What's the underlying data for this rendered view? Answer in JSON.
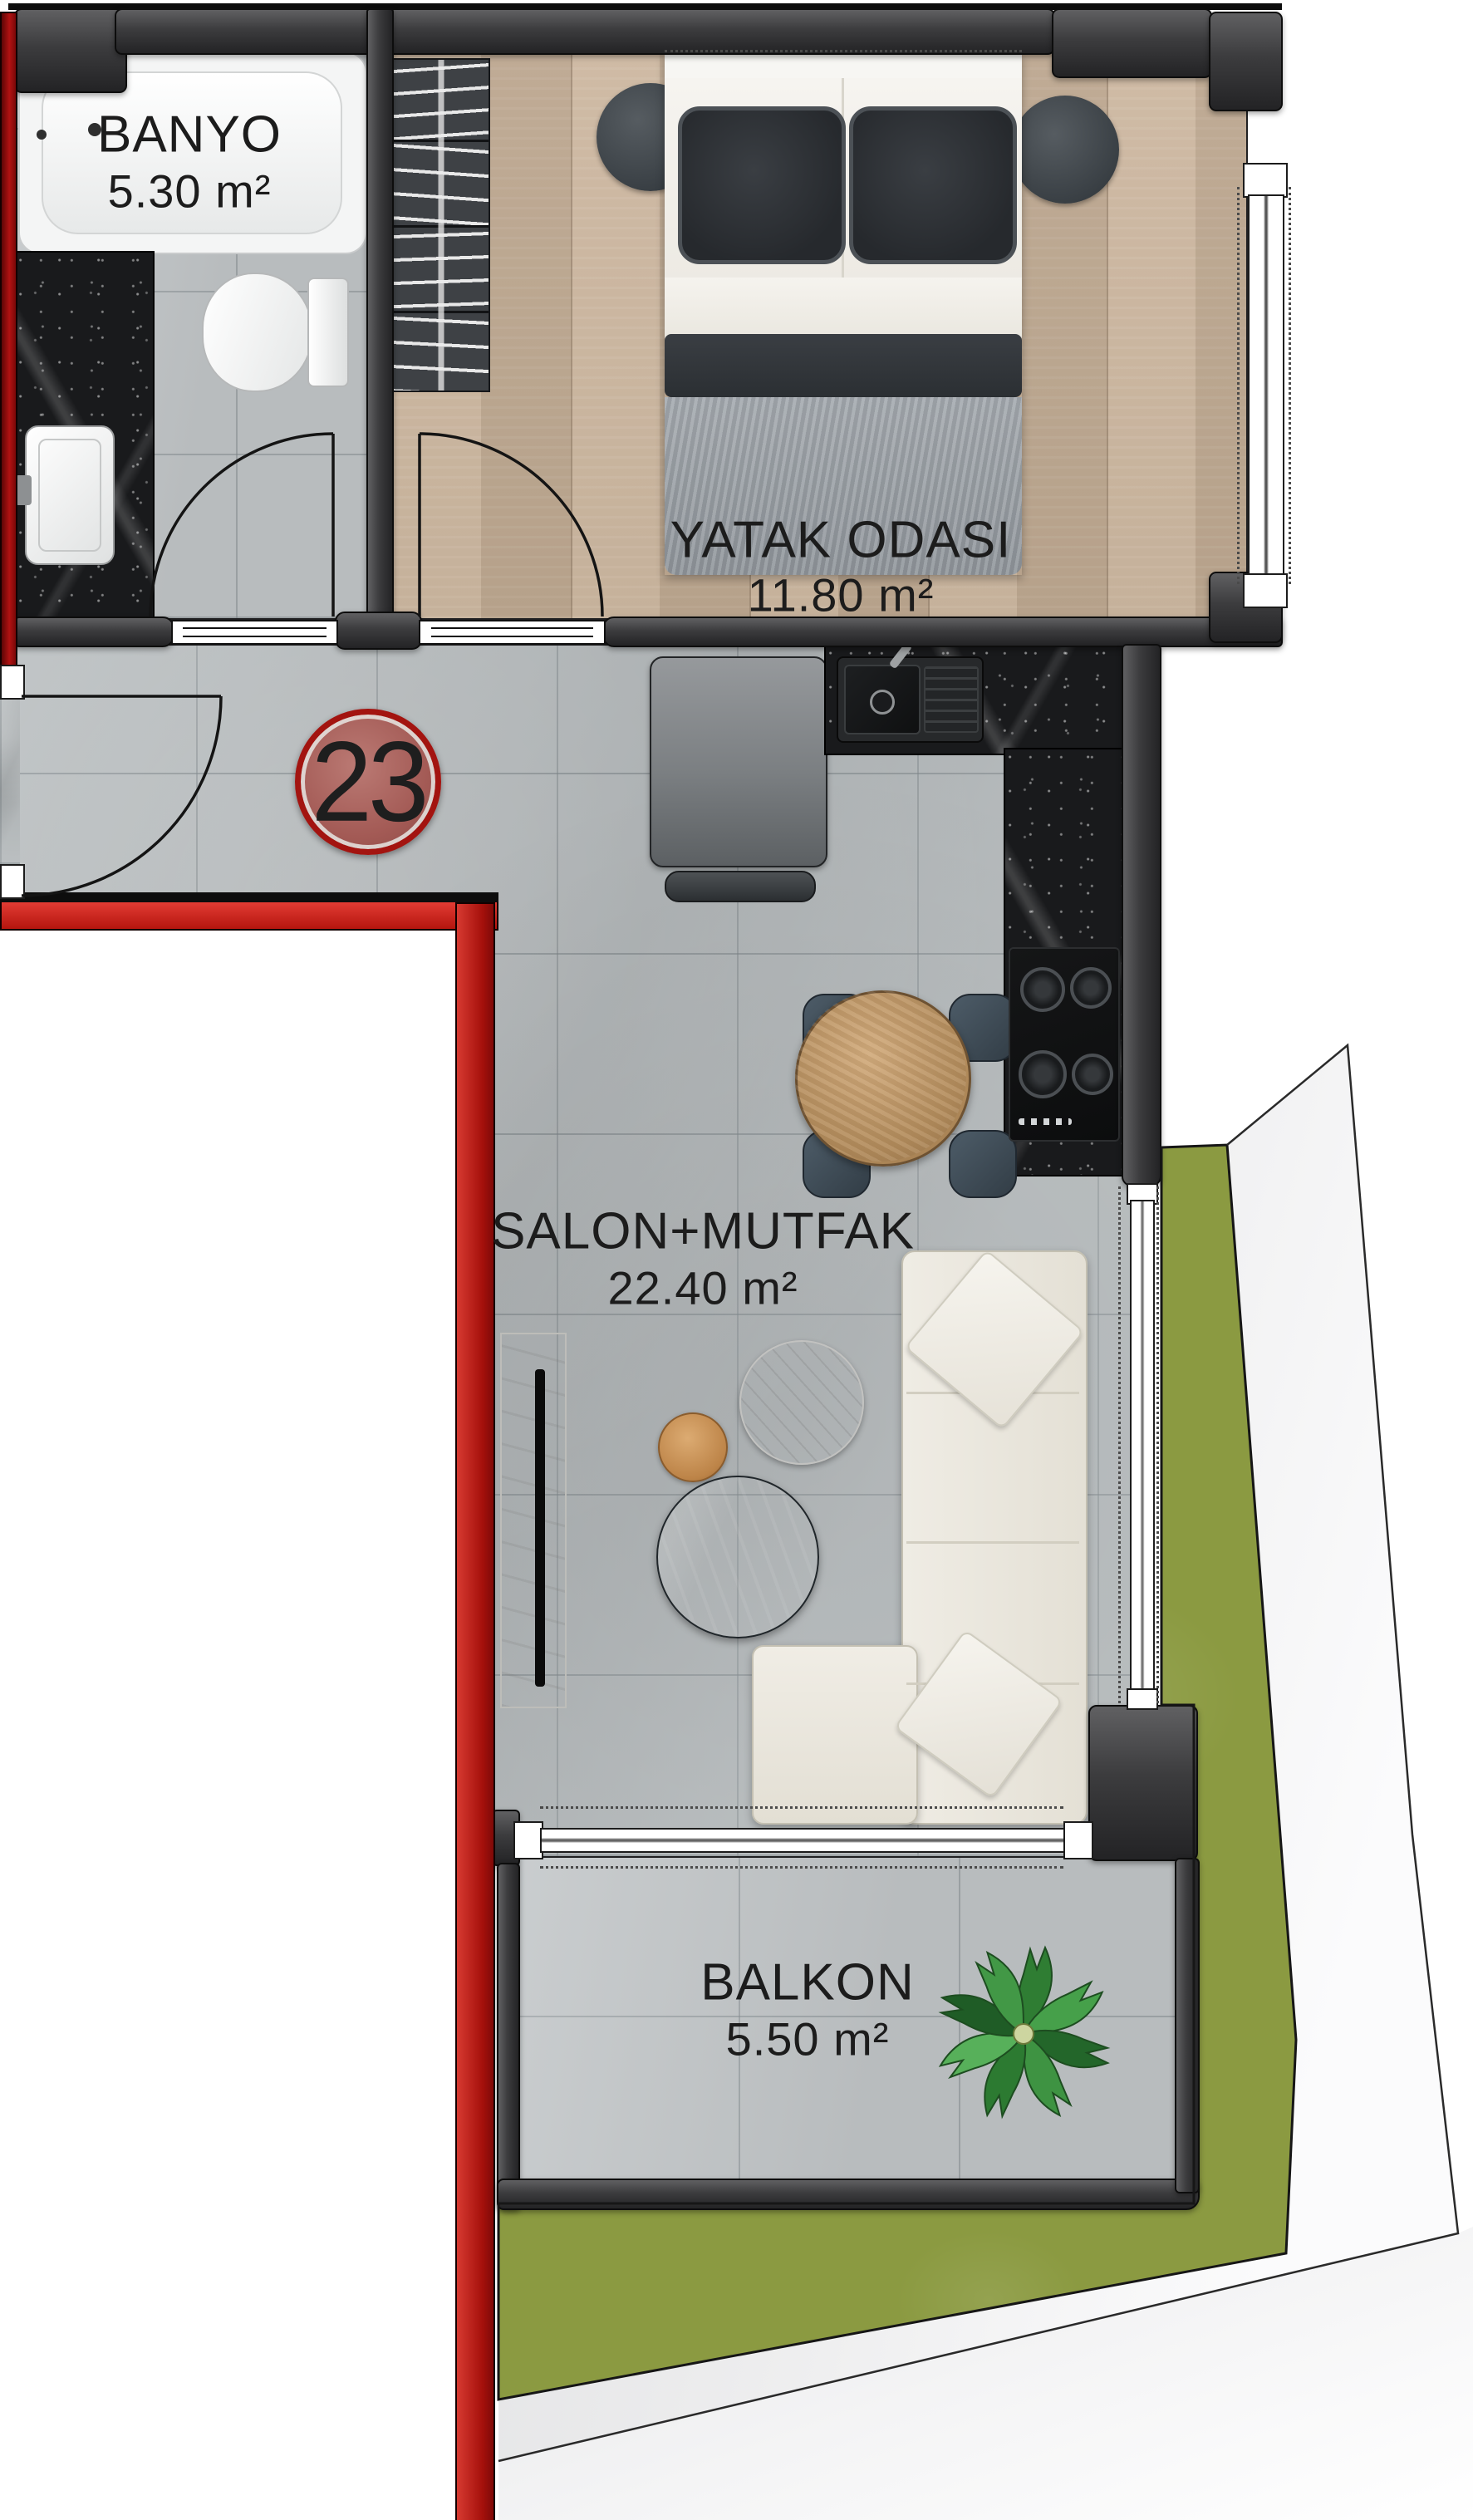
{
  "title": "Apartment unit 23 floor plan",
  "unit": {
    "number": "23"
  },
  "rooms": [
    {
      "id": "banyo",
      "label": "BANYO",
      "area": "5.30 m²"
    },
    {
      "id": "yatak-odasi",
      "label": "YATAK ODASI",
      "area": "11.80 m²"
    },
    {
      "id": "salon-mutfak",
      "label": "SALON+MUTFAK",
      "area": "22.40 m²"
    },
    {
      "id": "balkon",
      "label": "BALKON",
      "area": "5.50 m²"
    }
  ],
  "colors": {
    "unit_wall_red": "#c2221a",
    "badge_fill": "#a85d57",
    "badge_ring": "#a31410",
    "wall_dark": "#3a3a3c",
    "bedroom_wood": "#c9b299",
    "tile_gray": "#b5babc",
    "counter_marble": "#1a1b1d",
    "grass_green": "#8b9a41",
    "label_text": "#1c1c1c"
  },
  "furniture": {
    "bathroom": [
      "bathtub",
      "vanity-sink",
      "toilet"
    ],
    "bedroom": [
      "wardrobe",
      "double-bed",
      "bedside-rug-left",
      "bedside-rug-right"
    ],
    "kitchen": [
      "refrigerator",
      "kitchen-sink",
      "cooktop",
      "counter-column"
    ],
    "living": [
      "l-shaped-sofa",
      "tv-unit",
      "round-coffee-tables",
      "dining-table",
      "dining-chairs"
    ],
    "balcony": [
      "potted-plant"
    ]
  }
}
